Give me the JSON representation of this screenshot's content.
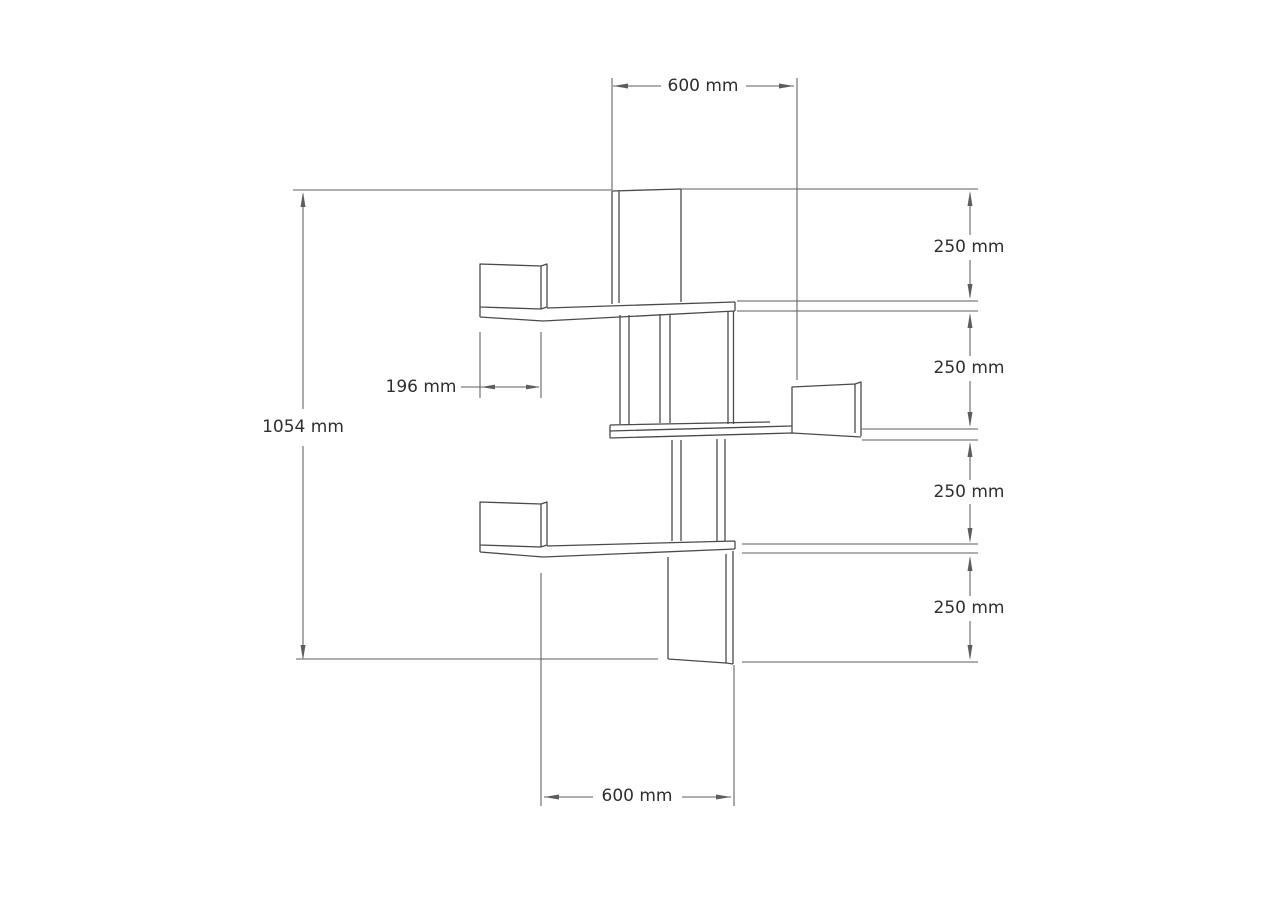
{
  "drawing": {
    "type": "technical-dimension-drawing",
    "subject": "corner wall shelf with four shelf levels",
    "background_color": "#ffffff",
    "line_color": "#4a4a4a",
    "dimension_line_color": "#5d5d5d",
    "text_color": "#2e2e2e",
    "dimensions": {
      "top_width": "600 mm",
      "bottom_width": "600 mm",
      "total_height": "1054 mm",
      "shelf_depth": "196 mm",
      "spacings": [
        "250 mm",
        "250 mm",
        "250 mm",
        "250 mm"
      ]
    }
  }
}
